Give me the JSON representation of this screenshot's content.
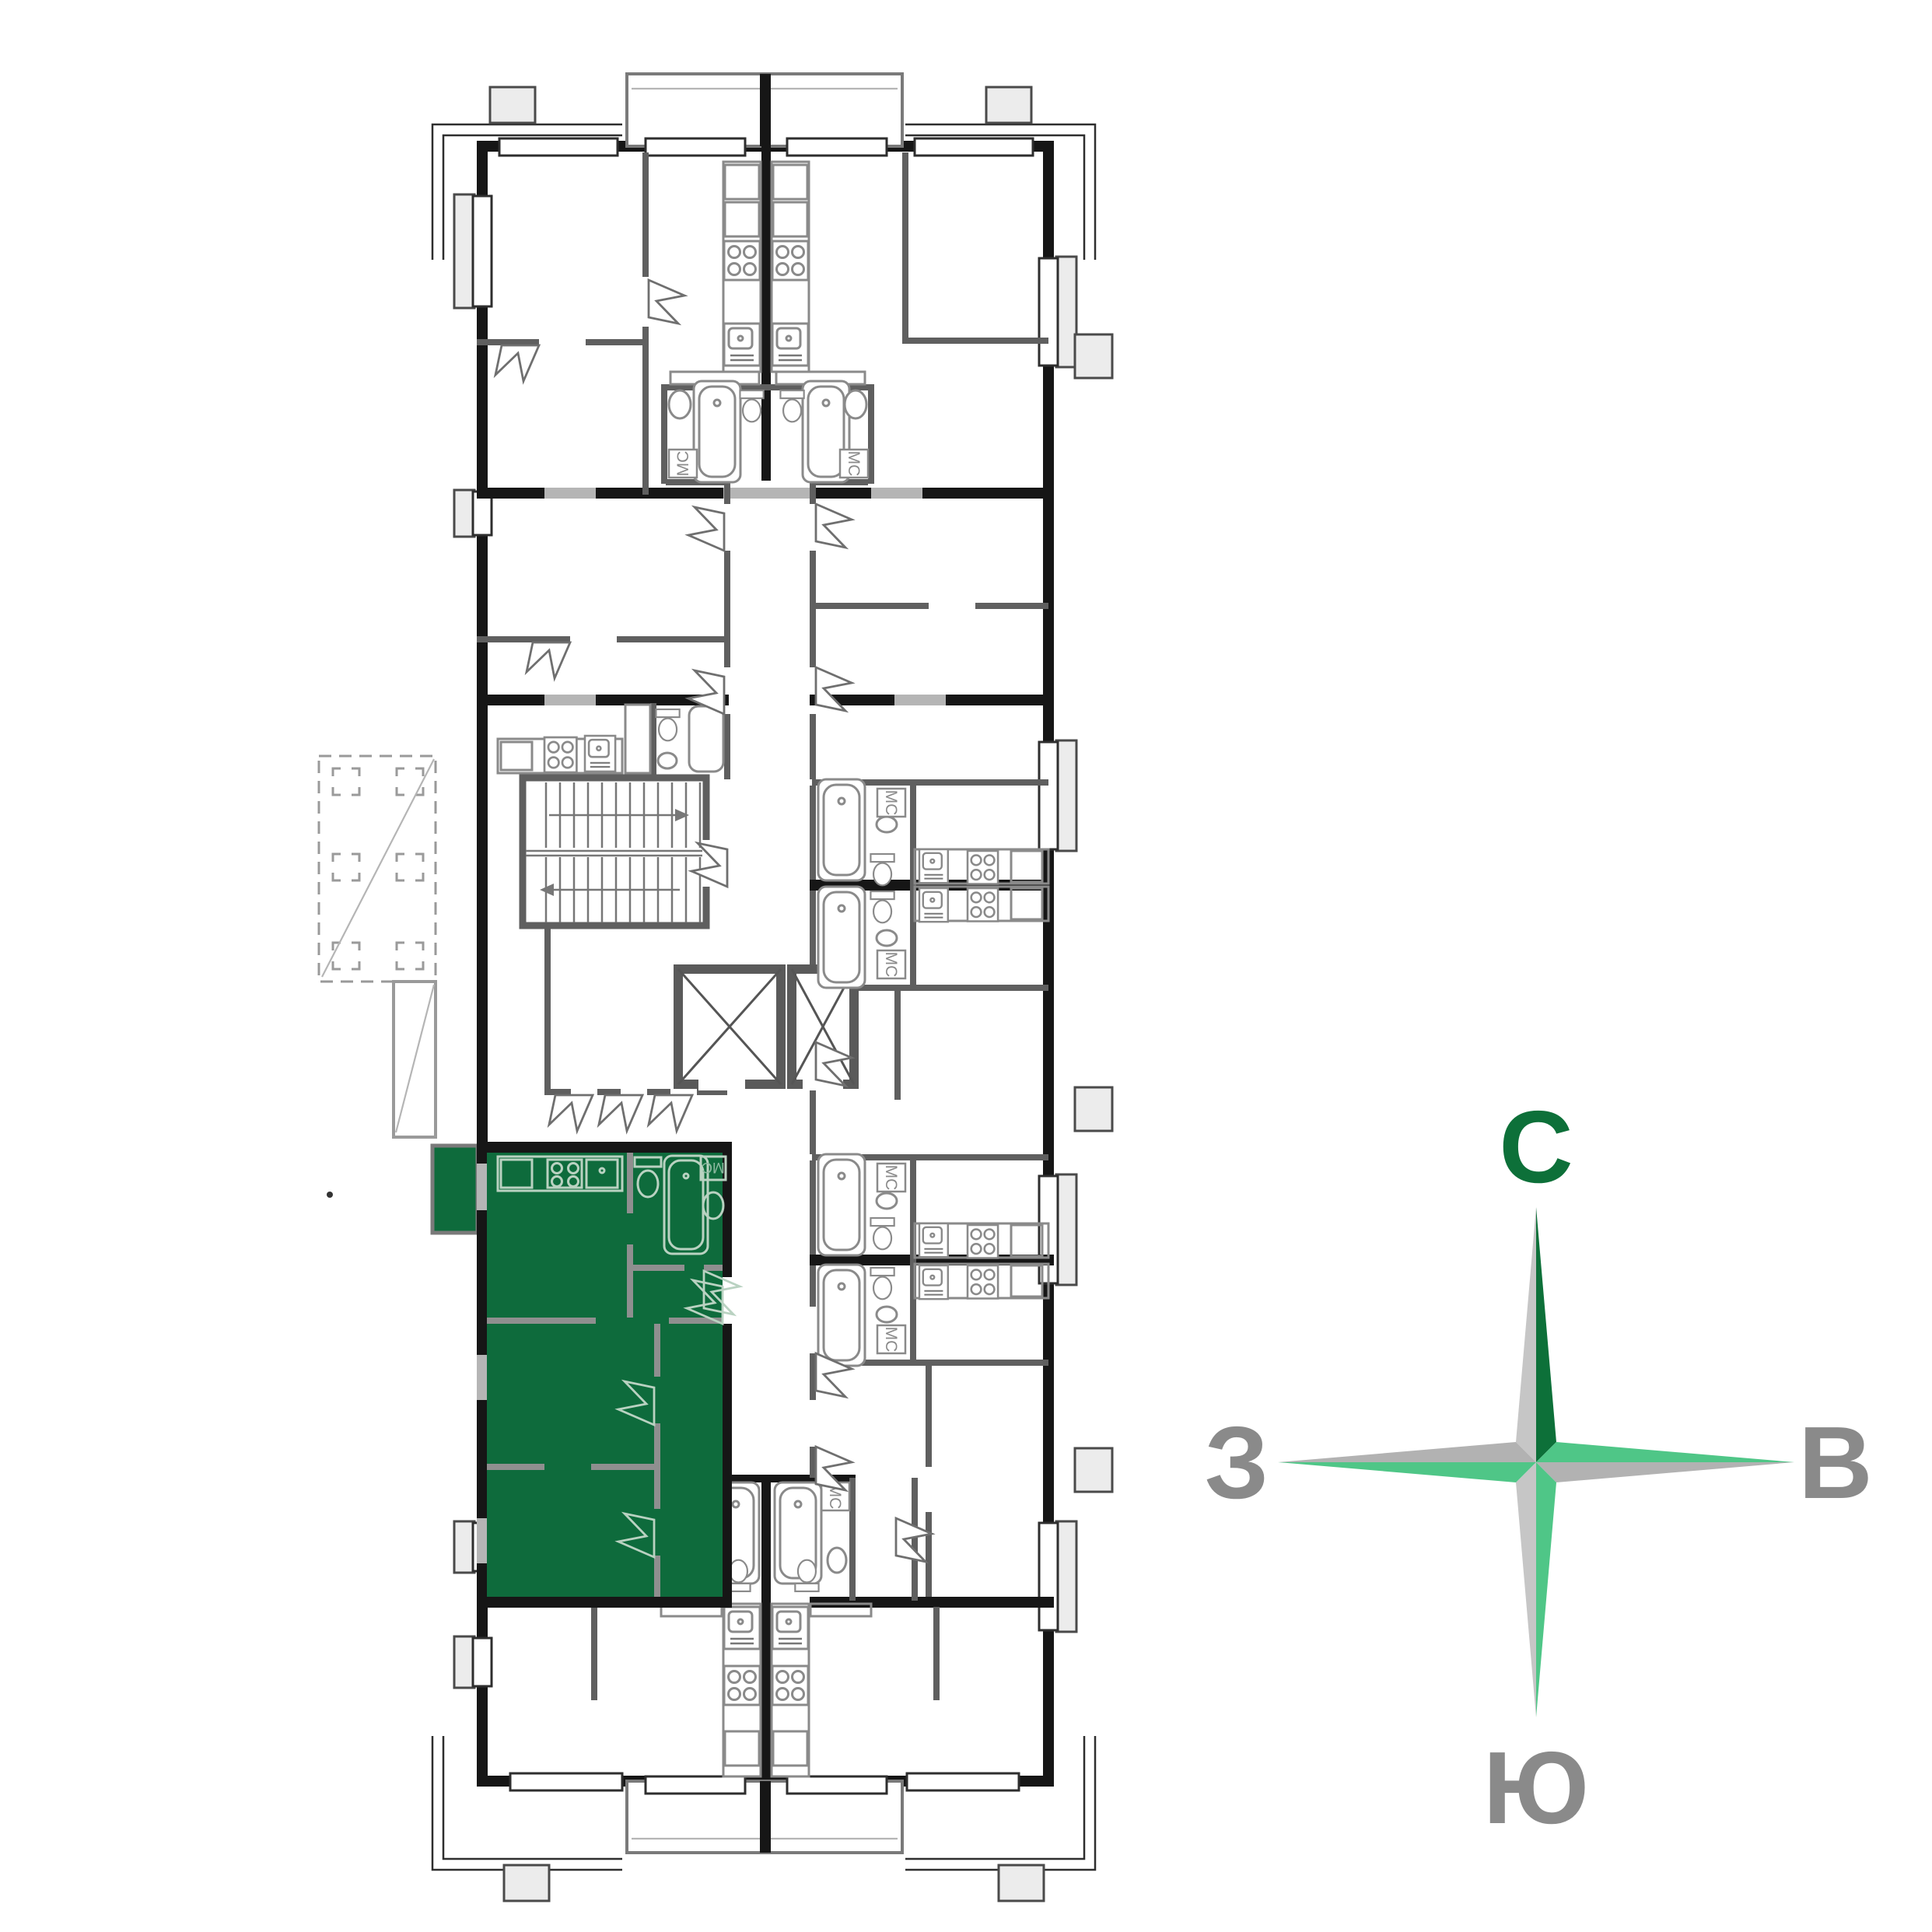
{
  "plan": {
    "washer_label": "МС",
    "highlight_color": "#0e6b3c",
    "wall_color": "#161616",
    "partition_color": "#5f5f5f",
    "fixture_line_color": "#8a8a8a",
    "highlight_fixture_line_color": "#b9d2c1"
  },
  "compass": {
    "north": "С",
    "east": "В",
    "south": "Ю",
    "west": "З",
    "north_color": "#0d7039",
    "accent_light": "#4fc687",
    "gray_light": "#c6c6c6",
    "gray": "#b2b2b2",
    "letter_color": "#8a8a8a"
  }
}
